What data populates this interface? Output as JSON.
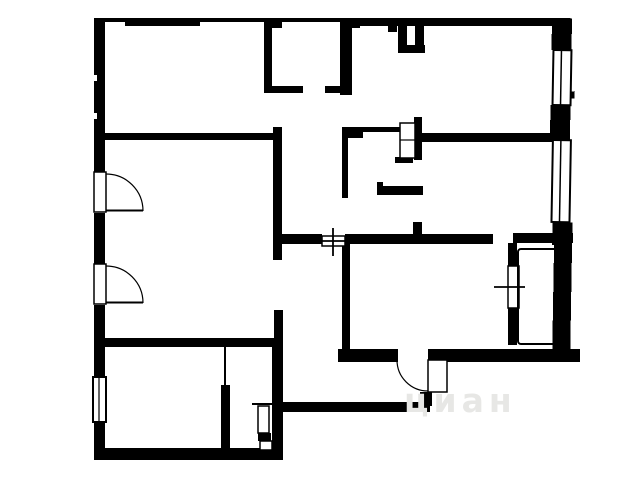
{
  "title": "apartment-floor-plan",
  "watermark": {
    "text": "циан",
    "color": "#e7e7e5"
  },
  "colors": {
    "wall": "#000000",
    "background": "#ffffff"
  },
  "symbols": {
    "door_arc": "quarter-circle swing",
    "window": "double-line rectangle",
    "cross_window": "rectangle with plus cross",
    "vent_shaft": "divided small rectangle",
    "closet": "thin outlined cells"
  }
}
